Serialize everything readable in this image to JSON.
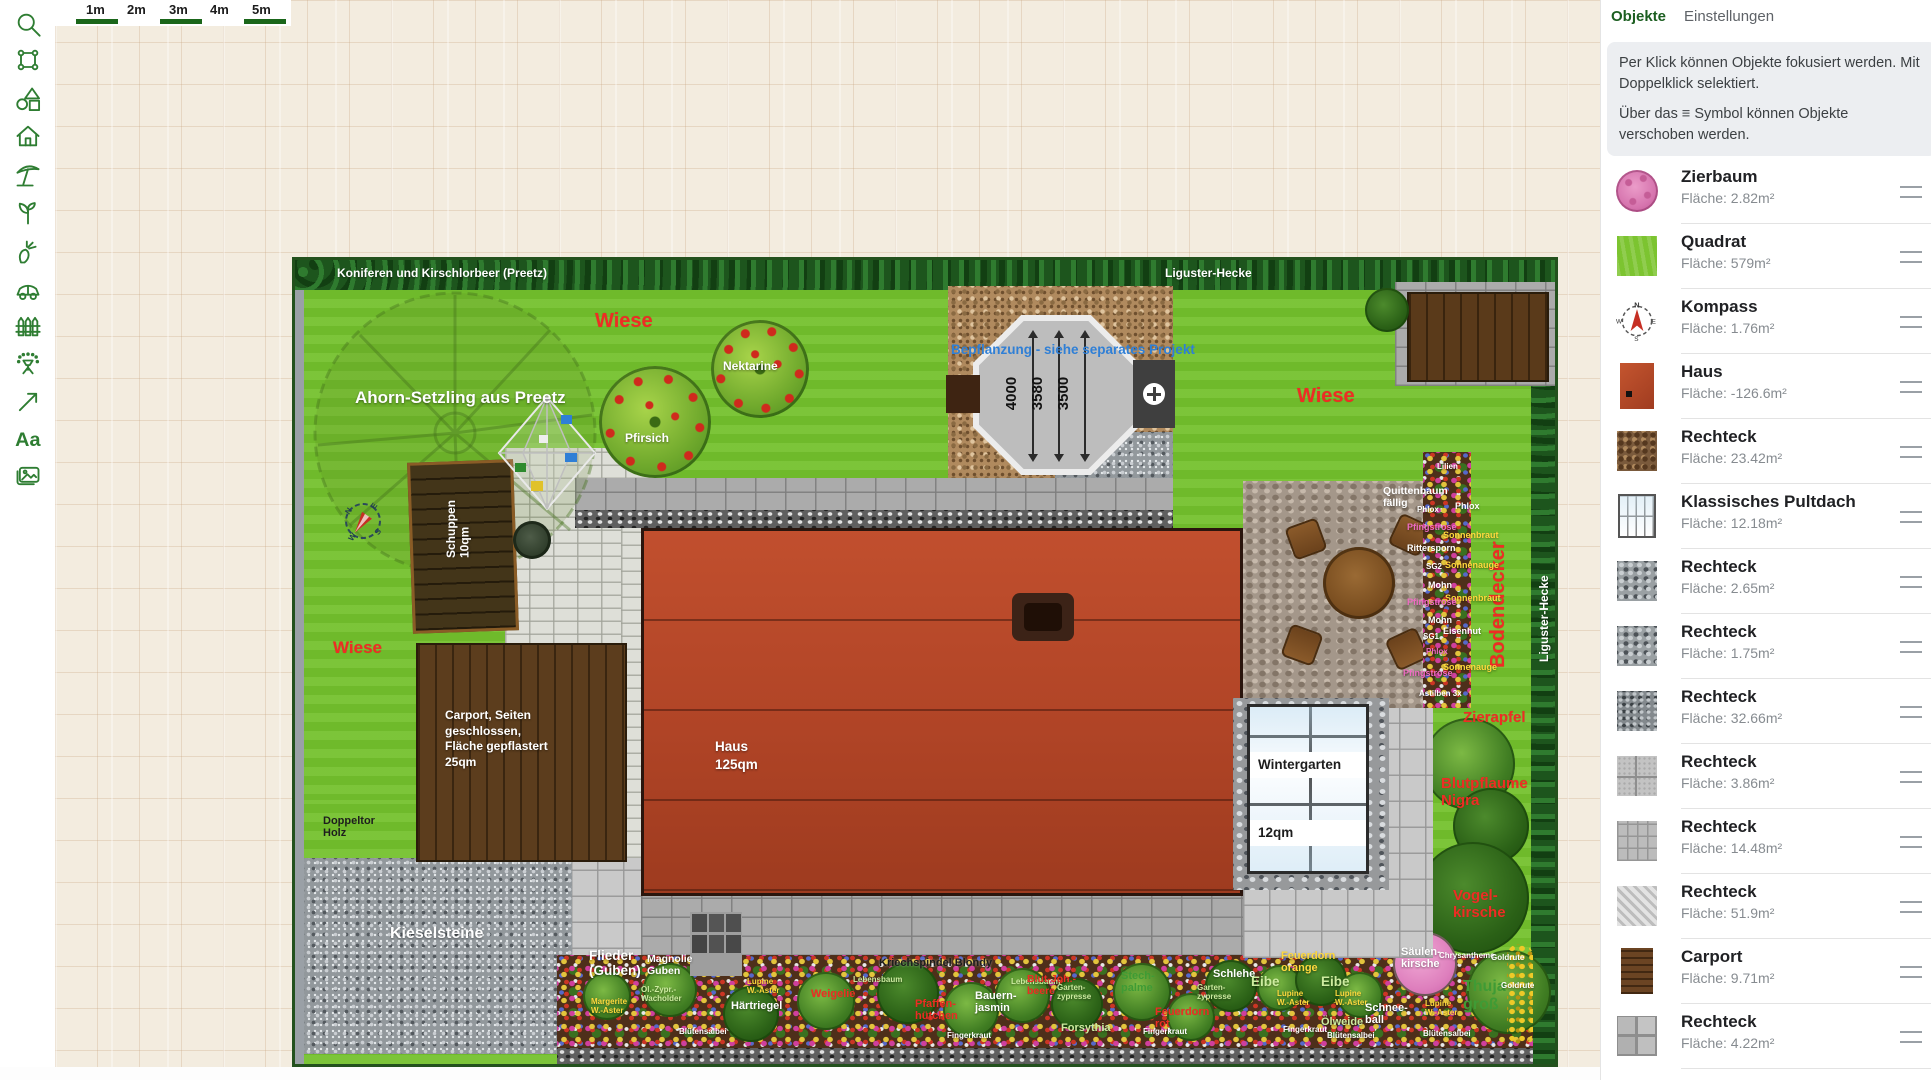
{
  "ruler": {
    "labels": [
      "1m",
      "2m",
      "3m",
      "4m",
      "5m"
    ]
  },
  "toolbar": {
    "icons": [
      "search",
      "transform",
      "shapes",
      "house",
      "parasol",
      "plant",
      "vegetable",
      "car",
      "fence",
      "irrigation",
      "arrow",
      "text",
      "image"
    ],
    "text_label": "Aa"
  },
  "panel": {
    "tabs": [
      "Objekte",
      "Einstellungen"
    ],
    "hint1": "Per Klick können Objekte fokusiert werden. Mit Doppelklick selektiert.",
    "hint2": "Über das ≡ Symbol können Objekte verschoben werden.",
    "items": [
      {
        "title": "Zierbaum",
        "area": "Fläche: 2.82m²",
        "thumb": "pink-tree"
      },
      {
        "title": "Quadrat",
        "area": "Fläche: 579m²",
        "thumb": "green-square"
      },
      {
        "title": "Kompass",
        "area": "Fläche: 1.76m²",
        "thumb": "compass"
      },
      {
        "title": "Haus",
        "area": "Fläche: -126.6m²",
        "thumb": "red-roof"
      },
      {
        "title": "Rechteck",
        "area": "Fläche: 23.42m²",
        "thumb": "brown-cobble"
      },
      {
        "title": "Klassisches Pultdach",
        "area": "Fläche: 12.18m²",
        "thumb": "glass-roof"
      },
      {
        "title": "Rechteck",
        "area": "Fläche: 2.65m²",
        "thumb": "gravel"
      },
      {
        "title": "Rechteck",
        "area": "Fläche: 1.75m²",
        "thumb": "gravel"
      },
      {
        "title": "Rechteck",
        "area": "Fläche: 32.66m²",
        "thumb": "gravel-dark"
      },
      {
        "title": "Rechteck",
        "area": "Fläche: 3.86m²",
        "thumb": "tiles-light"
      },
      {
        "title": "Rechteck",
        "area": "Fläche: 14.48m²",
        "thumb": "pavers"
      },
      {
        "title": "Rechteck",
        "area": "Fläche: 51.9m²",
        "thumb": "hatch"
      },
      {
        "title": "Carport",
        "area": "Fläche: 9.71m²",
        "thumb": "wood"
      },
      {
        "title": "Rechteck",
        "area": "Fläche: 4.22m²",
        "thumb": "tiles-big"
      },
      {
        "title": "Rechteck",
        "area": "",
        "thumb": "wood-dark"
      }
    ]
  },
  "plan": {
    "hedge_top_left": "Koniferen und Kirschlorbeer (Preetz)",
    "hedge_top_right": "Liguster-Hecke",
    "ahorn": "Ahorn-Setzling aus Preetz",
    "wiese": "Wiese",
    "pfirsich": "Pfirsich",
    "nektarine": "Nektarine",
    "bepflanzung": "Bepflanzung - siehe separates Projekt",
    "dims": [
      "4000",
      "3580",
      "3500"
    ],
    "schuppen": "Schuppen\n10qm",
    "carport": "Carport, Seiten\ngeschlossen,\nFläche gepflastert\n25qm",
    "haus": "Haus\n125qm",
    "wintergarten": "Wintergarten",
    "wintergarten_qm": "12qm",
    "doppeltor": "Doppeltor\nHolz",
    "kieselsteine": "Kieselsteine",
    "bodendecker": "Bodendecker",
    "liguster_vertical": "Liguster-Hecke",
    "zierapfel": "Zierapfel",
    "blutpflaume": "Blutpflaume\nNigra",
    "vogelkirsche": "Vogel-\nkirsche",
    "quittenbaum": "Quittenbaum\nfällig",
    "compass": [
      "N",
      "E",
      "S",
      "W"
    ],
    "strip": [
      "Lilien",
      "Phlox",
      "Phlox",
      "Pfingstrose",
      "Sonnenbraut",
      "Rittersporn",
      "SG2",
      "Sonnenauge",
      "Mohn",
      "Sonnenbraut",
      "Pfingstrose",
      "Mohn",
      "Eisenhut",
      "SG1",
      "Phlox",
      "Sonnenauge",
      "Pfingstrose",
      "Astilben 3x"
    ],
    "bed": [
      "Flieder\n(Guben)",
      "Magnolie\nGuben",
      "Margerite\nW.-Aster",
      "Öl.-Zypr.-\nWacholder",
      "Blütensalbei",
      "Härtriegel",
      "Lupine\nW.-Aster",
      "Weigelie",
      "Lebensbaum",
      "Kriechspindel Blondy",
      "Pfaffen-\nhütchen",
      "Fingerkraut",
      "Bauern-\njasmin",
      "Lebensbaum",
      "Blut-Joh.-\nbeere",
      "Garten-\nzypresse",
      "Forsythia",
      "Fingerkraut",
      "Stech-\npalme",
      "Garten-\nzypresse",
      "Feuerdorn\nrot",
      "Lupine\nW.-Aster",
      "Fingerkraut",
      "Schlehe",
      "Eibe",
      "Feuerdorn\norange",
      "Eibe",
      "Lupine\nW.-Aster",
      "Ölweide",
      "Blütensalbei",
      "Schnee-\nball",
      "Säulen-\nkirsche",
      "Chrysantheme",
      "Goldrute",
      "Thuja\ngroß",
      "Goldrute",
      "Blütensalbei",
      "Lupine\nW.-Aster"
    ]
  }
}
